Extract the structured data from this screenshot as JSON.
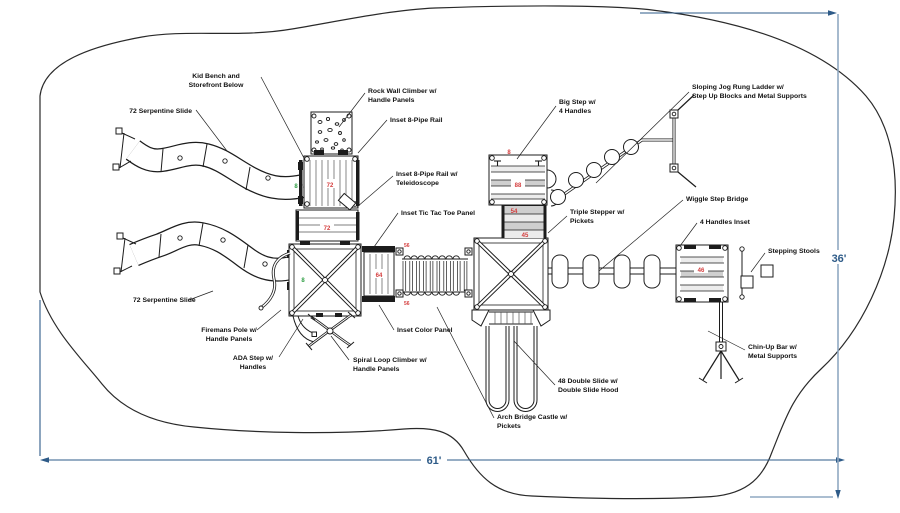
{
  "drawing_title": "Playground equipment plan view",
  "dimensions": {
    "width_label": "61'",
    "height_label": "36'"
  },
  "labels": {
    "kid_bench": [
      "Kid Bench and",
      "Storefront Below"
    ],
    "serpentine_top": [
      "72 Serpentine Slide"
    ],
    "rock_wall": [
      "Rock Wall Climber w/",
      "Handle Panels"
    ],
    "pipe_rail_top": [
      "Inset 8-Pipe Rail"
    ],
    "pipe_rail_tele": [
      "Inset 8-Pipe Rail w/",
      "Teleidoscope"
    ],
    "tic_tac_toe": [
      "Inset Tic Tac Toe Panel"
    ],
    "big_step": [
      "Big Step w/",
      "4 Handles"
    ],
    "jog_ladder": [
      "Sloping Jog Rung Ladder w/",
      "Step Up Blocks and Metal Supports"
    ],
    "wiggle_bridge": [
      "Wiggle Step Bridge"
    ],
    "triple_stepper": [
      "Triple Stepper w/",
      "Pickets"
    ],
    "handles_inset": [
      "4 Handles Inset"
    ],
    "stepping_stools": [
      "Stepping Stools"
    ],
    "chin_up": [
      "Chin-Up Bar w/",
      "Metal Supports"
    ],
    "serpentine_bottom": [
      "72 Serpentine Slide"
    ],
    "firemans_pole": [
      "Firemans Pole w/",
      "Handle Panels"
    ],
    "ada_step": [
      "ADA Step w/",
      "Handles"
    ],
    "spiral_loop": [
      "Spiral Loop Climber w/",
      "Handle Panels"
    ],
    "color_panel": [
      "Inset Color Panel"
    ],
    "double_slide": [
      "48 Double Slide w/",
      "Double Slide Hood"
    ],
    "arch_bridge": [
      "Arch Bridge Castle w/",
      "Pickets"
    ]
  },
  "deck_numbers": {
    "tower_top": "72",
    "tower_mid": "72",
    "x_deck_green": "8",
    "bench_green": "8",
    "small_deck": "64",
    "bridge_post_top": "56",
    "bridge_post_bottom": "56",
    "big_step_top": "8",
    "big_step_mid": "88",
    "stepper_upper": "54",
    "stepper_lower": "45",
    "right_deck": "46"
  },
  "colors": {
    "line": "#1c1c1c",
    "dimension_line": "#2e5b88",
    "dimension_extension": "#8fa8c2",
    "red_number": "#d43c3c",
    "green_number": "#2f9e44"
  }
}
